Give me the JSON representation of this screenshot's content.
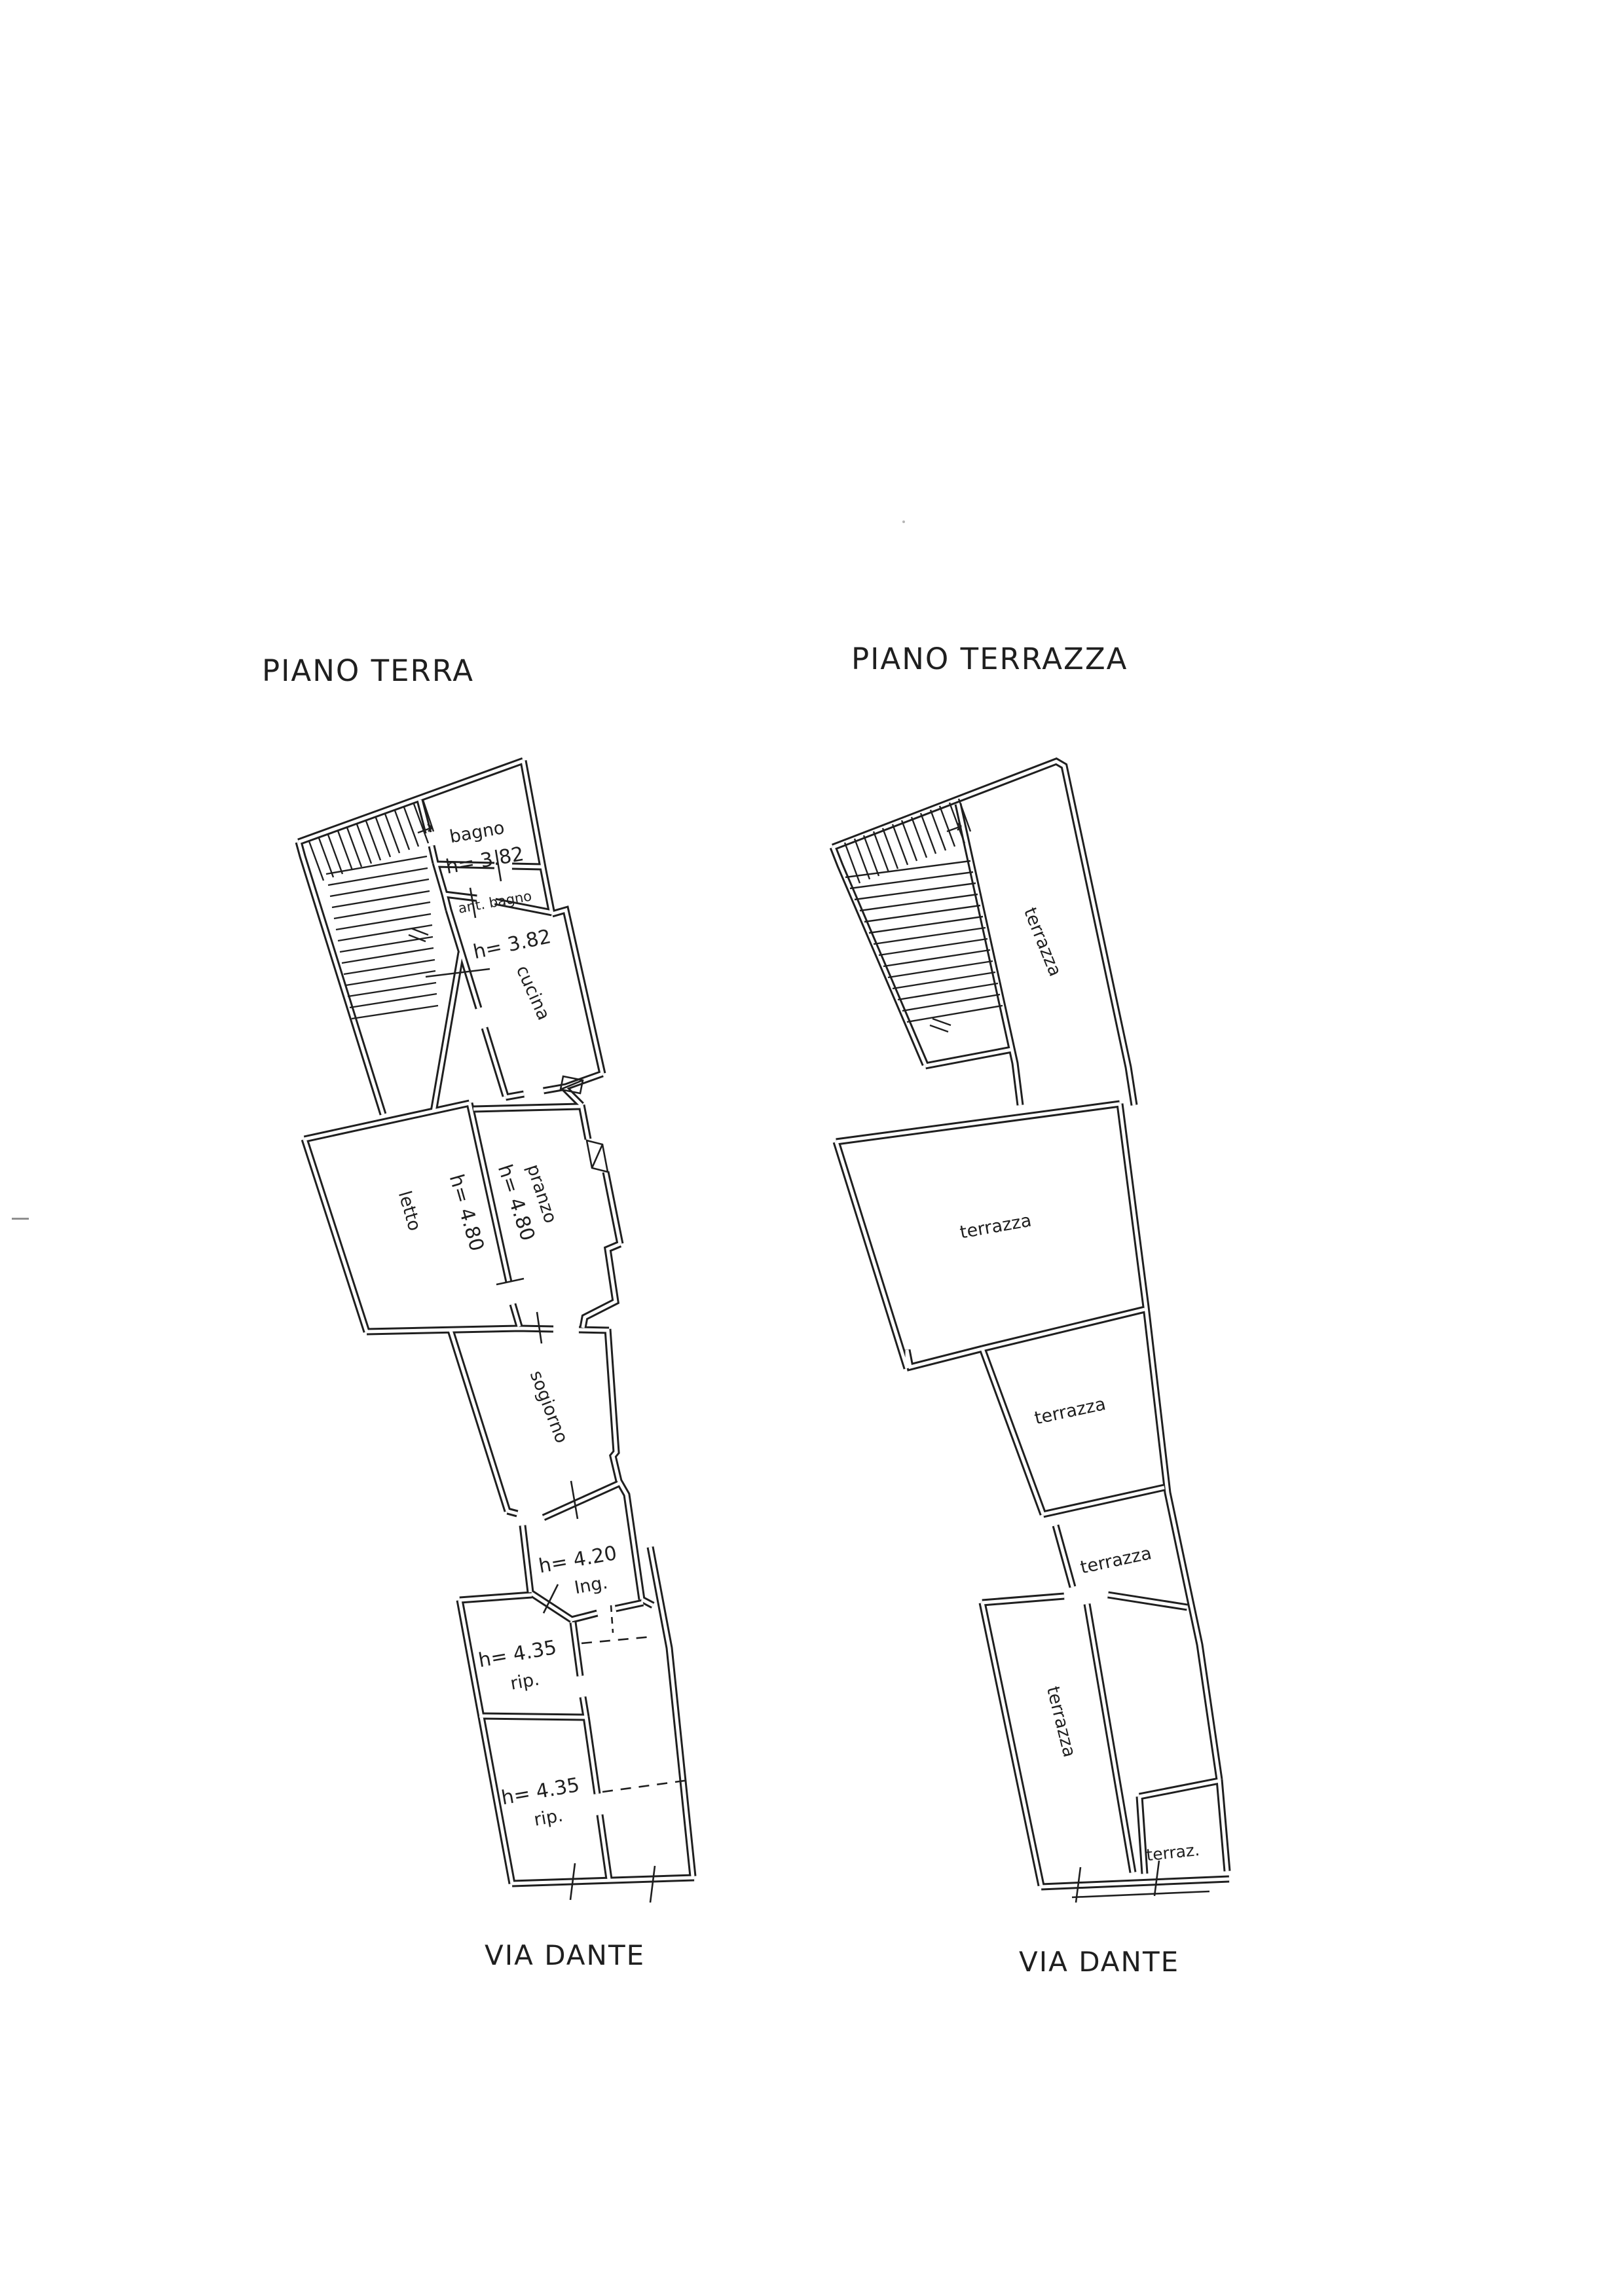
{
  "ink_color": "#1f1f1f",
  "plans": [
    {
      "title": "PIANO TERRA",
      "street_label": "VIA DANTE",
      "rooms": [
        {
          "name": "bagno",
          "height": "h= 3.82"
        },
        {
          "name": "ant. bagno"
        },
        {
          "name": "cucina",
          "height": "h= 3.82"
        },
        {
          "name": "letto",
          "height": "h= 4.80"
        },
        {
          "name": "pranzo",
          "height": "h= 4.80"
        },
        {
          "name": "sogiorno"
        },
        {
          "name": "Ing.",
          "height": "h= 4.20"
        },
        {
          "name": "rip.",
          "height": "h= 4.35"
        },
        {
          "name": "rip.",
          "height": "h= 4.35"
        }
      ]
    },
    {
      "title": "PIANO TERRAZZA",
      "street_label": "VIA DANTE",
      "rooms": [
        {
          "name": "terrazza"
        },
        {
          "name": "terrazza"
        },
        {
          "name": "terrazza"
        },
        {
          "name": "terrazza"
        },
        {
          "name": "terrazza"
        },
        {
          "name": "terraz."
        }
      ]
    }
  ]
}
